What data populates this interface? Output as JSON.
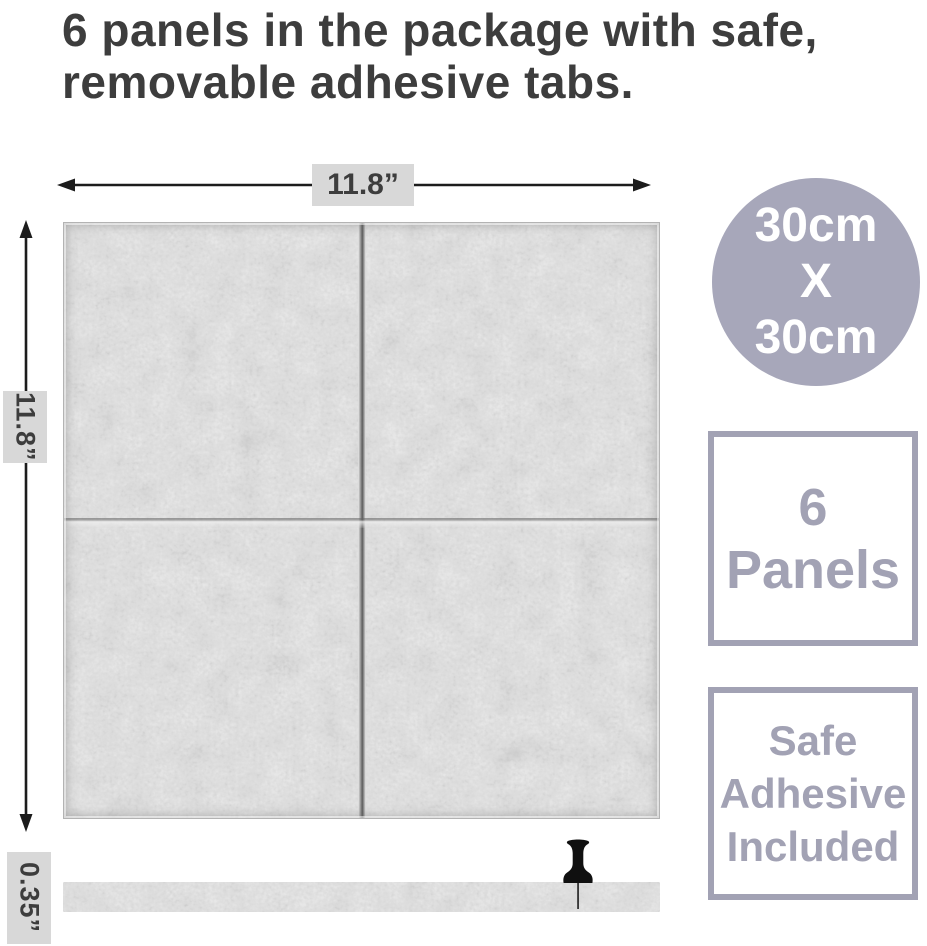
{
  "title": {
    "lines": [
      "6 panels in the package with safe,",
      "removable adhesive tabs."
    ]
  },
  "dimensions": {
    "width_label": "11.8”",
    "height_label": "11.8”",
    "thickness_label": "0.35”"
  },
  "badges": {
    "size_circle": {
      "lines": [
        "30cm",
        "X",
        "30cm"
      ]
    },
    "panel_count": {
      "lines": [
        "6",
        "Panels"
      ]
    },
    "adhesive": {
      "lines": [
        "Safe",
        "Adhesive",
        "Included"
      ]
    }
  },
  "icons": {
    "pushpin": "pushpin-icon",
    "width_arrow": "horizontal-double-arrow-icon",
    "height_arrow": "vertical-double-arrow-icon"
  },
  "colors": {
    "title_color": "#3d3d3d",
    "accent": "#a7a7ba",
    "badge_border": "#a2a2b4",
    "badge_text": "#a2a2b4",
    "circle_text": "#ffffff",
    "label_bg": "#d8d8d8",
    "line_color": "#1c1c1c",
    "felt_base": "#c6c6c6"
  }
}
